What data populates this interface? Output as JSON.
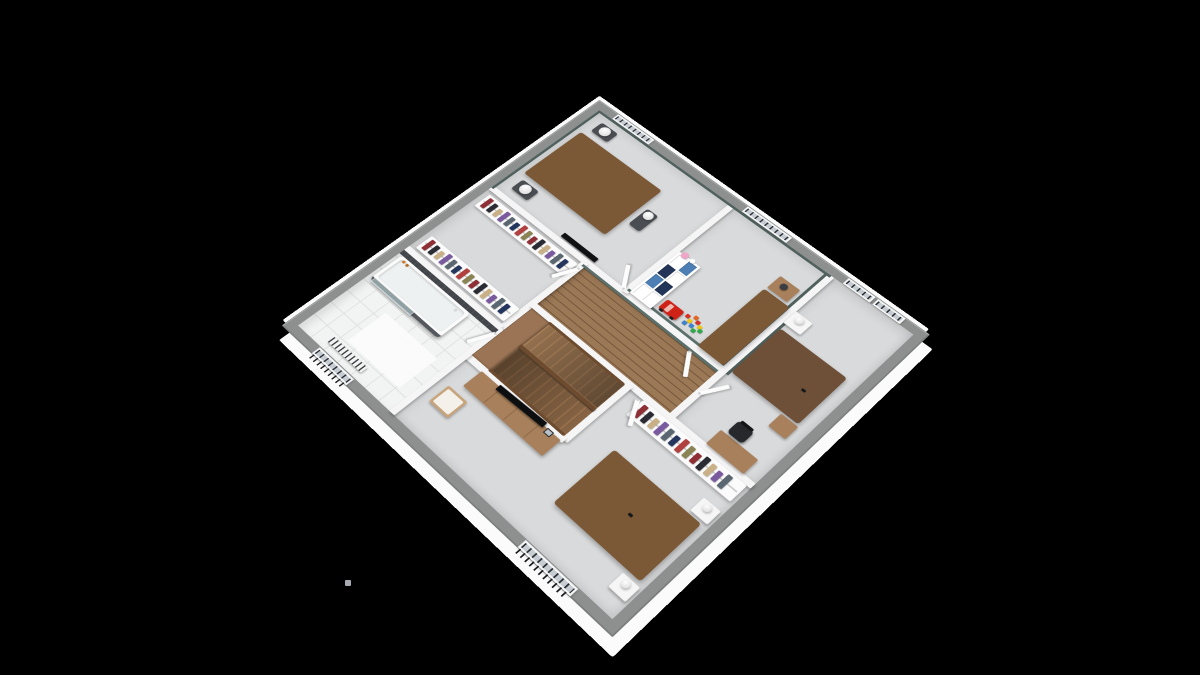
{
  "scene": {
    "background": "#000000",
    "camera": {
      "perspective": 2500,
      "origin_x": 605,
      "origin_y": 330,
      "scale": 0.53,
      "rotateX": 36,
      "rotateZ": 45
    },
    "plan": {
      "w": 880,
      "h": 850,
      "wall": 22,
      "wall_color": "#8e9090",
      "skirt_color": "#fbfbfb"
    },
    "palette": {
      "teal_wall": "#50615d",
      "teal_blanket": "#5e7d7a",
      "aqua_blanket": "#abdcd4",
      "yellow_pillow": "#e3dc2f",
      "beige_blanket": "#e7d7bc",
      "bed_wood": "#7b5836",
      "light_wood": "#a8805b",
      "dark_tile": "#43464b",
      "stool_gray": "#4a4e52",
      "carpet": "#d9dadb",
      "glass": "rgba(195,220,223,0.55)",
      "car_red": "#cf2318",
      "shelf_blue": "#4d7fb5",
      "shelf_navy": "#223457",
      "pink_toy": "#f0a6c8",
      "clothes": [
        "#8e2f35",
        "#2b2b33",
        "#c9b087",
        "#7a5a9e",
        "#5b6770",
        "#24355e",
        "#b0413e",
        "#8a8455"
      ],
      "toys": [
        "#d93025",
        "#f2c511",
        "#3b82d0",
        "#2faa4a",
        "#e8641f"
      ]
    },
    "speck": {
      "x": 345,
      "y": 580,
      "w": 6,
      "h": 6,
      "color": "#b9bdc5"
    },
    "floors": [
      {
        "name": "bedroom1-floor",
        "kind": "carpet",
        "x": 22,
        "y": 22,
        "w": 381,
        "h": 313
      },
      {
        "name": "kidroom-floor",
        "kind": "carpet",
        "x": 403,
        "y": 22,
        "w": 257,
        "h": 313
      },
      {
        "name": "bedroom2-floor",
        "kind": "carpet",
        "x": 660,
        "y": 22,
        "w": 198,
        "h": 458
      },
      {
        "name": "dressing-floor",
        "kind": "carpet",
        "x": 22,
        "y": 335,
        "w": 276,
        "h": 225
      },
      {
        "name": "bathroom-floor",
        "kind": "tile",
        "x": 22,
        "y": 560,
        "w": 276,
        "h": 268
      },
      {
        "name": "bedroom3-floor",
        "kind": "carpet",
        "x": 298,
        "y": 480,
        "w": 560,
        "h": 348
      },
      {
        "name": "hall-floor",
        "kind": "wood",
        "x": 298,
        "y": 335,
        "w": 362,
        "h": 145
      },
      {
        "name": "stairwell-floor",
        "kind": "wood",
        "x": 298,
        "y": 480,
        "w": 262,
        "h": 168
      }
    ],
    "partitions": [
      {
        "name": "wall-bed1-hall",
        "x": 22,
        "y": 328,
        "w": 638,
        "h": 14
      },
      {
        "name": "wall-bed1-kid",
        "x": 396,
        "y": 22,
        "w": 14,
        "h": 313
      },
      {
        "name": "wall-kid-bed2",
        "x": 653,
        "y": 22,
        "w": 14,
        "h": 458
      },
      {
        "name": "wall-dressing-hall",
        "x": 291,
        "y": 335,
        "w": 14,
        "h": 225
      },
      {
        "name": "wall-dressing-bath",
        "x": 22,
        "y": 553,
        "w": 276,
        "h": 14
      },
      {
        "name": "wall-bed3-north",
        "x": 298,
        "y": 473,
        "w": 560,
        "h": 14
      },
      {
        "name": "wall-stairwell-east",
        "x": 553,
        "y": 480,
        "w": 14,
        "h": 168
      },
      {
        "name": "wall-stairwell-south",
        "x": 298,
        "y": 641,
        "w": 262,
        "h": 14
      },
      {
        "name": "wall-bath-bed3",
        "x": 291,
        "y": 560,
        "w": 14,
        "h": 268
      }
    ],
    "accents": [
      {
        "name": "teal-wall-bed1-west",
        "x": 22,
        "y": 22,
        "w": 6,
        "h": 313,
        "color": "#50615d"
      },
      {
        "name": "teal-wall-bed1-north",
        "x": 22,
        "y": 22,
        "w": 381,
        "h": 6,
        "color": "#50615d"
      },
      {
        "name": "teal-wall-kid-north",
        "x": 403,
        "y": 22,
        "w": 257,
        "h": 6,
        "color": "#50615d"
      },
      {
        "name": "teal-wall-kid-east",
        "x": 647,
        "y": 22,
        "w": 6,
        "h": 306,
        "color": "#50615d"
      },
      {
        "name": "teal-wall-kid-south",
        "x": 403,
        "y": 322,
        "w": 250,
        "h": 6,
        "color": "#5c706b"
      },
      {
        "name": "teal-wall-hall-north",
        "x": 298,
        "y": 342,
        "w": 355,
        "h": 6,
        "color": "#5c706b"
      },
      {
        "name": "teal-wall-bed2-headboard",
        "x": 667,
        "y": 160,
        "w": 6,
        "h": 178,
        "color": "#50615d"
      },
      {
        "name": "dark-tile-wall-bathroom",
        "x": 22,
        "y": 567,
        "w": 276,
        "h": 12,
        "color": "#43464b"
      }
    ],
    "windows": [
      {
        "name": "window-bedroom1",
        "x": 60,
        "y": 3,
        "w": 105,
        "h": 17
      },
      {
        "name": "window-kidroom",
        "x": 428,
        "y": 3,
        "w": 115,
        "h": 17
      },
      {
        "name": "window-bedroom2-a",
        "x": 688,
        "y": 3,
        "w": 64,
        "h": 17
      },
      {
        "name": "window-bedroom2-b",
        "x": 760,
        "y": 3,
        "w": 64,
        "h": 17
      },
      {
        "name": "window-bathroom",
        "x": 92,
        "y": 831,
        "w": 100,
        "h": 17,
        "bars": true
      },
      {
        "name": "window-bedroom3",
        "x": 655,
        "y": 831,
        "w": 125,
        "h": 17,
        "bars": true
      }
    ],
    "doors": [
      {
        "name": "door-bedroom1",
        "hx": 396,
        "hy": 326,
        "len": 60,
        "rot": -125
      },
      {
        "name": "door-kidroom",
        "hx": 586,
        "hy": 344,
        "len": 58,
        "rot": 55
      },
      {
        "name": "door-dressing",
        "hx": 300,
        "hy": 352,
        "len": 56,
        "rot": 115
      },
      {
        "name": "door-bathroom",
        "hx": 300,
        "hy": 572,
        "len": 56,
        "rot": 115
      },
      {
        "name": "door-bedroom2",
        "hx": 662,
        "hy": 400,
        "len": 58,
        "rot": -60
      },
      {
        "name": "door-bedroom3",
        "hx": 592,
        "hy": 489,
        "len": 58,
        "rot": 60
      }
    ],
    "furniture": [
      {
        "kind": "bed",
        "name": "double-bed-bedroom1",
        "x": 40,
        "y": 95,
        "w": 235,
        "h": 165,
        "head": "left",
        "frame": "#7b5836",
        "blanket": "#5e7d7a",
        "pillowColors": [
          "#ffffff",
          "#ffffff"
        ]
      },
      {
        "kind": "stool",
        "name": "bench-bedroom1-north",
        "x": 52,
        "y": 44,
        "w": 48,
        "h": 34
      },
      {
        "kind": "lamp",
        "name": "sphere-lamp",
        "x": 62,
        "y": 46,
        "r": 26
      },
      {
        "kind": "stool",
        "name": "bench-bedroom1-south",
        "x": 52,
        "y": 274,
        "w": 48,
        "h": 34
      },
      {
        "kind": "lamp",
        "name": "sphere-lamp",
        "x": 62,
        "y": 276,
        "r": 26
      },
      {
        "kind": "stool",
        "name": "bench-bedroom1-foot",
        "x": 288,
        "y": 150,
        "w": 30,
        "h": 56
      },
      {
        "kind": "lamp",
        "name": "sphere-lamp",
        "x": 291,
        "y": 152,
        "r": 22
      },
      {
        "kind": "tvwall",
        "name": "wall-tv-bedroom1",
        "x": 215,
        "y": 312,
        "w": 95,
        "h": 12
      },
      {
        "kind": "rail",
        "name": "clothes-rail-dressing-north",
        "x": 34,
        "y": 350,
        "w": 256,
        "h": 42
      },
      {
        "kind": "rail",
        "name": "clothes-rail-dressing-south",
        "x": 34,
        "y": 505,
        "w": 256,
        "h": 42
      },
      {
        "kind": "tub",
        "name": "bathtub",
        "x": 30,
        "y": 579,
        "w": 202,
        "h": 82
      },
      {
        "kind": "glass",
        "name": "shower-glass-screen",
        "x": 36,
        "y": 652,
        "w": 116,
        "h": 10
      },
      {
        "kind": "dots",
        "name": "shampoo-bottles",
        "x": 42,
        "y": 584,
        "size": 7,
        "pattern": [
          [
            0,
            0
          ],
          [
            11,
            1
          ],
          [
            160,
            6
          ]
        ],
        "colors": [
          "#c87a2a",
          "#b46a22",
          "#d8d8d8"
        ]
      },
      {
        "kind": "mat",
        "name": "bath-mat",
        "x": 116,
        "y": 692,
        "w": 150,
        "h": 92
      },
      {
        "kind": "radiator",
        "name": "towel-radiator",
        "x": 92,
        "y": 796,
        "w": 98,
        "h": 16
      },
      {
        "kind": "stairs",
        "name": "staircase",
        "x": 306,
        "y": 488,
        "w": 246,
        "h": 152
      },
      {
        "kind": "shelf",
        "name": "kids-shelf-unit",
        "x": 410,
        "y": 186,
        "w": 56,
        "h": 142,
        "cells": [
          "#ffffff",
          "#4d7fb5",
          "#223457",
          "#ffffff",
          "#4d7fb5",
          "#223457",
          "#ffffff",
          "#ffffff"
        ]
      },
      {
        "kind": "car",
        "name": "toy-car",
        "x": 474,
        "y": 288,
        "w": 44,
        "h": 28
      },
      {
        "kind": "toys",
        "name": "toy-blocks",
        "x": 524,
        "y": 276
      },
      {
        "kind": "table",
        "name": "kid-bedside-table",
        "x": 590,
        "y": 92,
        "w": 50,
        "h": 40
      },
      {
        "kind": "lampdark",
        "name": "kid-bedside-lamp",
        "x": 604,
        "y": 100,
        "r": 16
      },
      {
        "kind": "bed",
        "name": "single-bed-kidroom",
        "x": 588,
        "y": 138,
        "w": 64,
        "h": 190,
        "head": "top",
        "pad": 4,
        "frame": "#7b5836",
        "blanket": "#abdcd4",
        "pillowColors": [
          "#9aa2a8"
        ]
      },
      {
        "kind": "whitetable",
        "name": "bedside-table-bedroom2",
        "x": 666,
        "y": 136,
        "w": 40,
        "h": 36
      },
      {
        "kind": "lamp",
        "name": "bedside-lamp",
        "x": 676,
        "y": 140,
        "r": 18
      },
      {
        "kind": "bed",
        "name": "double-bed-bedroom2",
        "x": 672,
        "y": 188,
        "w": 160,
        "h": 140,
        "head": "left",
        "frame": "#6e4f38",
        "blanket": "#f4f4f2",
        "pillowColors": [
          "#ffffff",
          "#e3dc2f"
        ]
      },
      {
        "kind": "dot",
        "name": "phone-on-bed",
        "x": 788,
        "y": 262,
        "w": 9,
        "h": 6
      },
      {
        "kind": "table",
        "name": "corner-table-bedroom2",
        "x": 796,
        "y": 332,
        "w": 40,
        "h": 36
      },
      {
        "kind": "desk",
        "name": "desk-bedroom2",
        "x": 742,
        "y": 434,
        "w": 88,
        "h": 40
      },
      {
        "kind": "chairblack",
        "name": "office-chair",
        "x": 752,
        "y": 396,
        "w": 36,
        "h": 34
      },
      {
        "kind": "rail",
        "name": "open-wardrobe-bedroom3",
        "x": 600,
        "y": 487,
        "w": 250,
        "h": 44
      },
      {
        "kind": "dresser",
        "name": "tv-dresser-bedroom3",
        "x": 345,
        "y": 652,
        "w": 210,
        "h": 46
      },
      {
        "kind": "tv",
        "name": "tv-bedroom3",
        "x": 392,
        "y": 646,
        "w": 120,
        "h": 13
      },
      {
        "kind": "frame",
        "name": "photo-frame",
        "x": 520,
        "y": 650,
        "w": 16,
        "h": 13
      },
      {
        "kind": "chairwood",
        "name": "chair-bedroom3",
        "x": 326,
        "y": 716,
        "w": 52,
        "h": 48
      },
      {
        "kind": "bed",
        "name": "double-bed-bedroom3",
        "x": 636,
        "y": 598,
        "w": 208,
        "h": 150,
        "head": "right",
        "frame": "#7b5836",
        "blanket": "#e7d7bc",
        "pillowColors": [
          "#e2cdb2",
          "#e2cdb2"
        ],
        "footDuvet": true
      },
      {
        "kind": "dot",
        "name": "phone-on-bed",
        "x": 742,
        "y": 668,
        "w": 9,
        "h": 6
      },
      {
        "kind": "whitetable",
        "name": "bedside-table-bedroom3-north",
        "x": 812,
        "y": 556,
        "w": 38,
        "h": 34
      },
      {
        "kind": "lamp",
        "name": "bedside-lamp",
        "x": 822,
        "y": 560,
        "r": 16
      },
      {
        "kind": "whitetable",
        "name": "bedside-table-bedroom3-south",
        "x": 812,
        "y": 756,
        "w": 38,
        "h": 34
      },
      {
        "kind": "lamp",
        "name": "bedside-lamp",
        "x": 822,
        "y": 760,
        "r": 16
      }
    ]
  }
}
